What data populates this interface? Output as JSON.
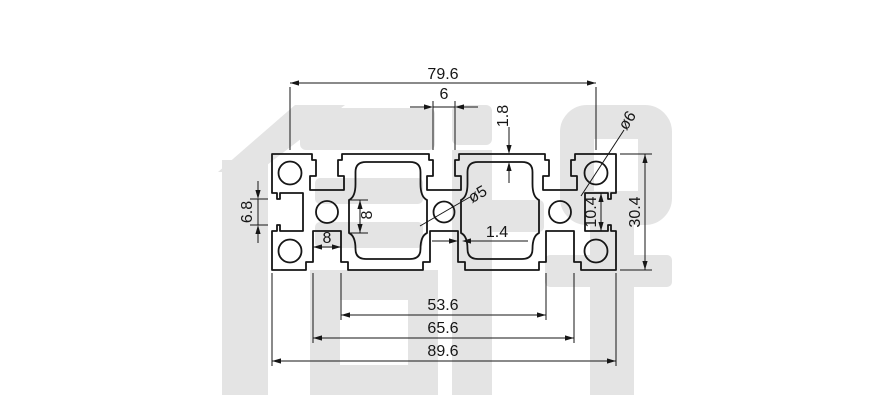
{
  "drawing": {
    "title": "aluminium-profile-cross-section",
    "watermark": {
      "text": "信牌"
    },
    "dims": {
      "top_hole_span": "79.6",
      "top_slot_width": "6",
      "top_wall_thickness": "1.8",
      "corner_hole_dia": "ø6",
      "left_slot_opening": "6.8",
      "mid_pocket_height": "8",
      "bottom_pocket_width": "8",
      "center_hole_dia": "ø5",
      "center_wall_thickness": "1.4",
      "right_pocket_height": "10.4",
      "overall_height": "30.4",
      "bottom_inner_span": "53.6",
      "bottom_mid_span": "65.6",
      "overall_width": "89.6"
    },
    "colors": {
      "line": "#161616",
      "watermark": "#e4e4e4",
      "background": "#ffffff"
    }
  }
}
